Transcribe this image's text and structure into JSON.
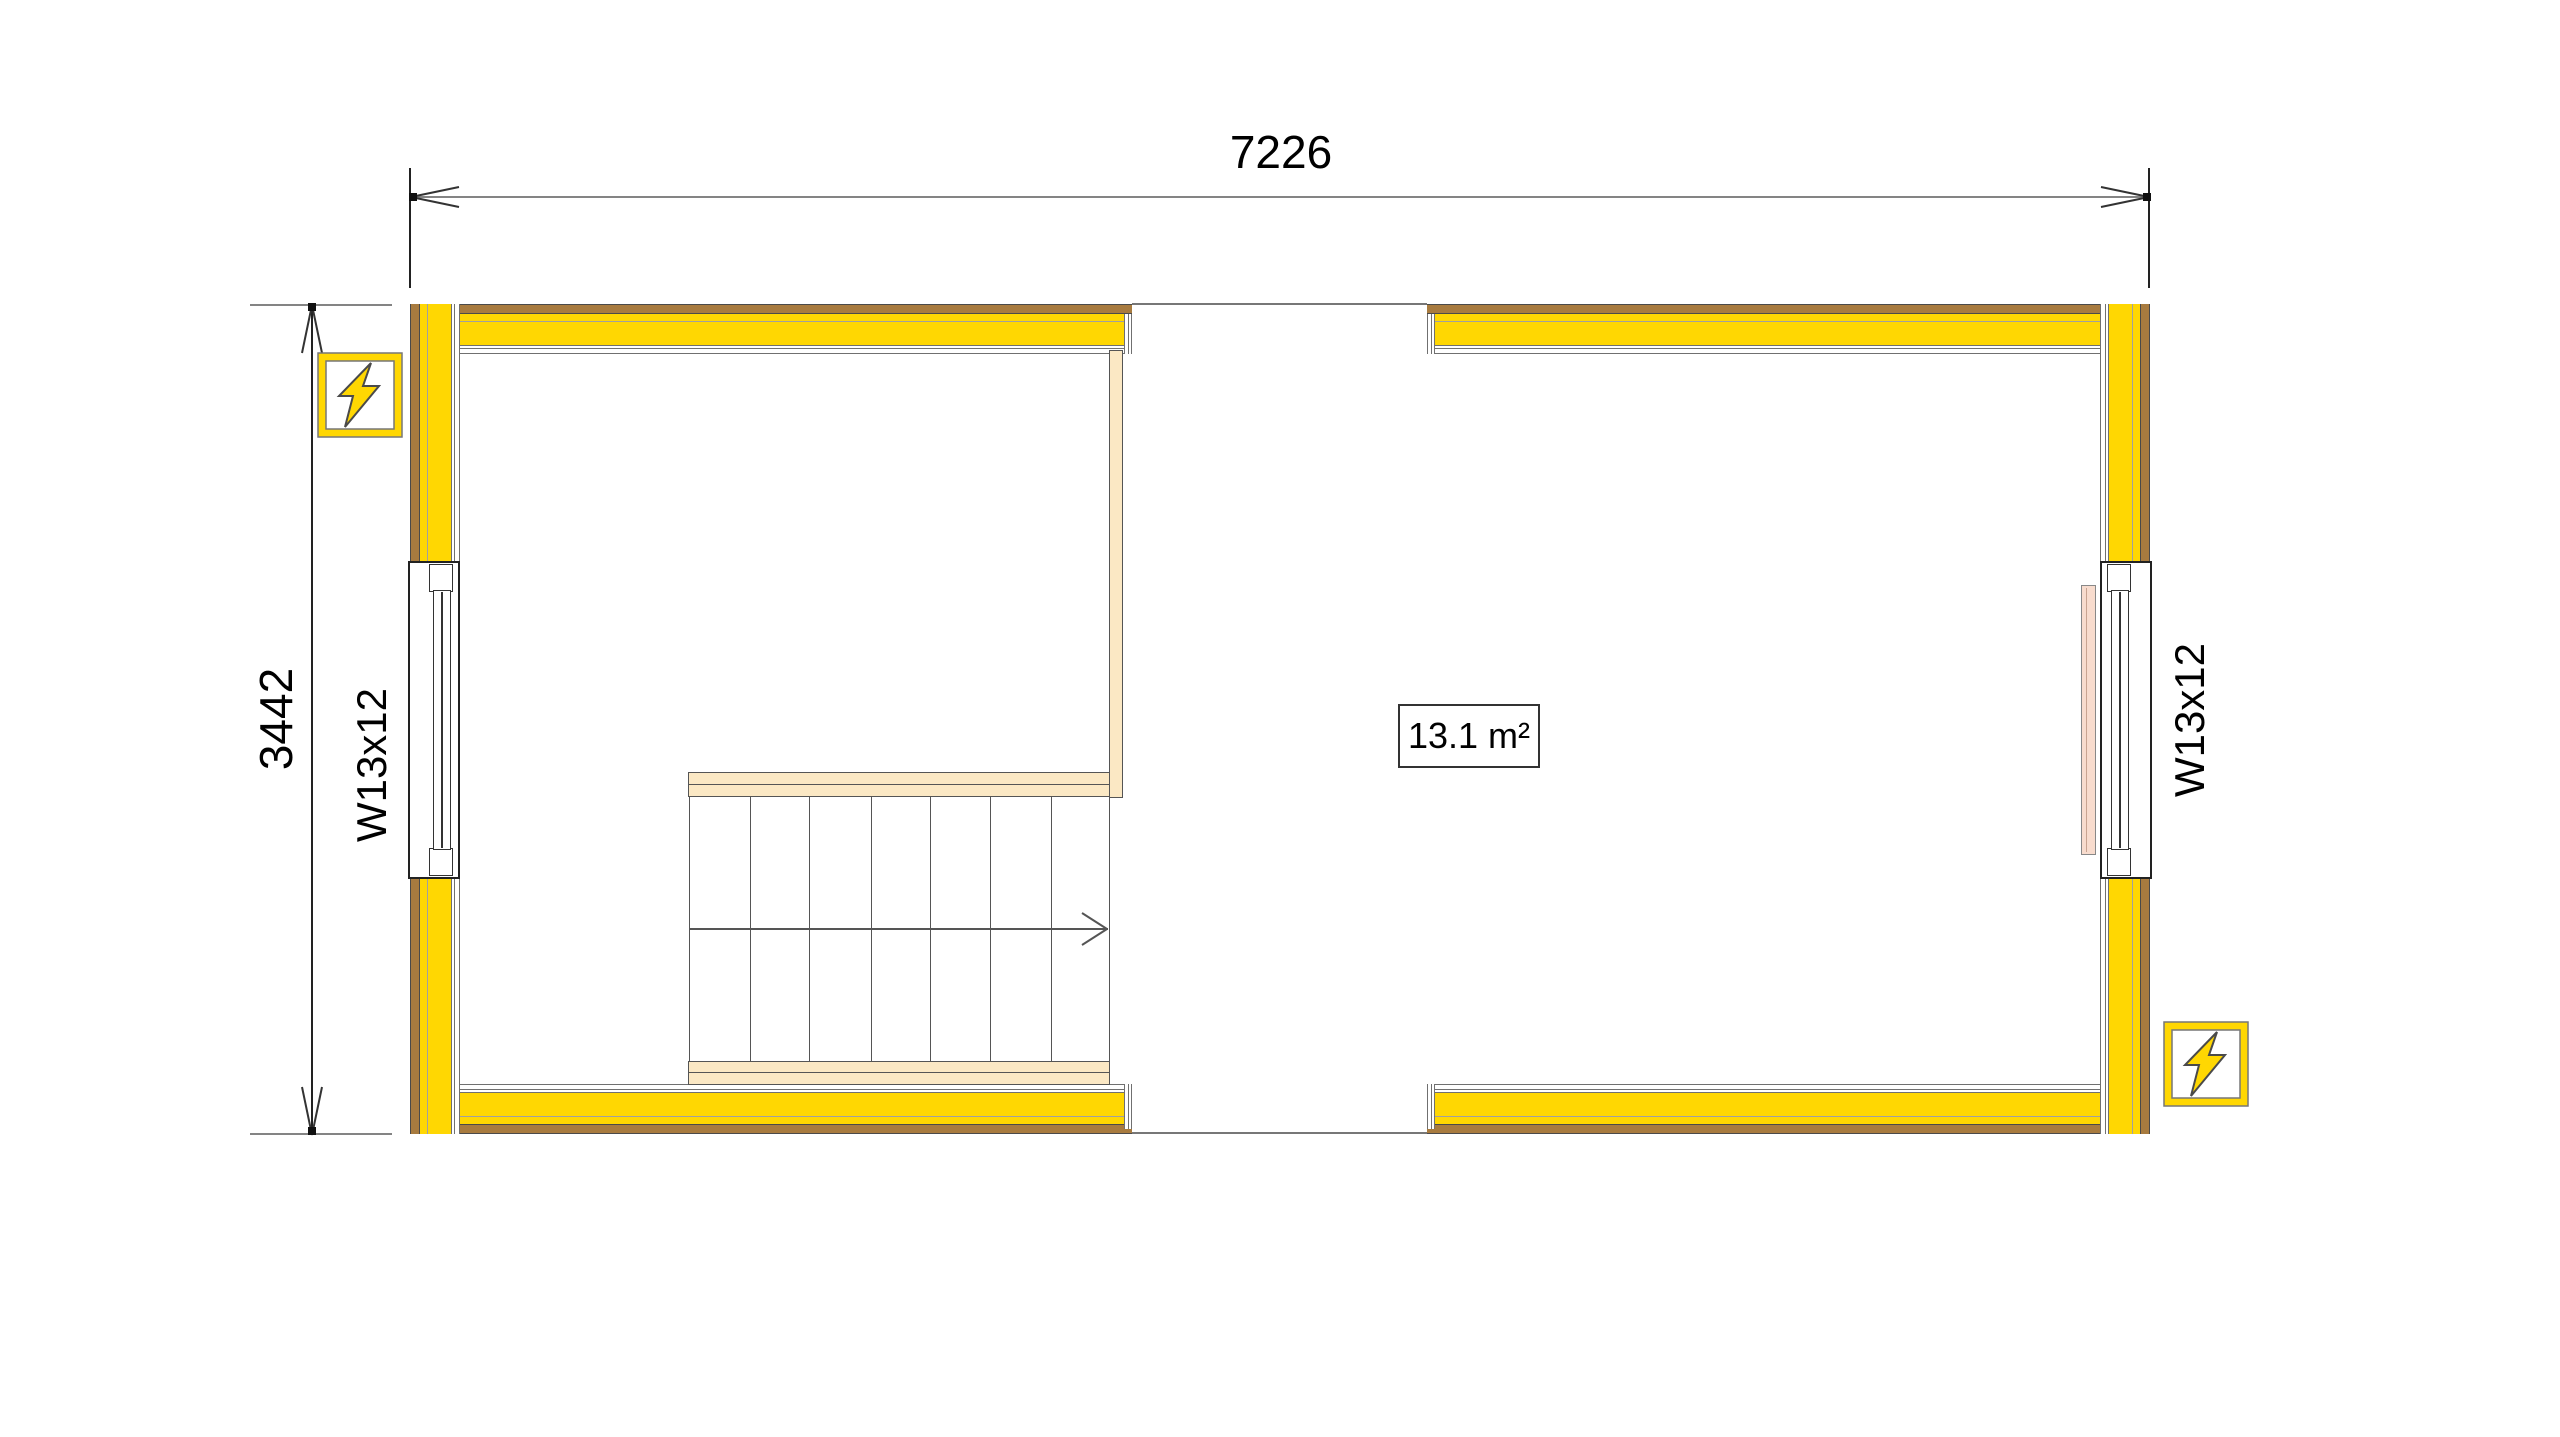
{
  "drawing": {
    "kind": "floor-plan",
    "dimensions": {
      "width_label": "7226",
      "height_label": "3442"
    },
    "windows": {
      "left_label": "W13x12",
      "right_label": "W13x12"
    },
    "rooms": {
      "right_room_area_label": "13.1 m²"
    },
    "icons": {
      "electrical_top_left": "lightning-bolt-icon",
      "electrical_bottom_right": "lightning-bolt-icon"
    },
    "colors": {
      "insulation_yellow": "#FFD702",
      "cladding_brown": "#A87B3F",
      "stair_wood_cream": "#FBE8C4",
      "radiator_pink": "#F8DCCE",
      "line_gray": "#707070",
      "dim_line_gray": "#848484",
      "text_black": "#000000"
    }
  }
}
